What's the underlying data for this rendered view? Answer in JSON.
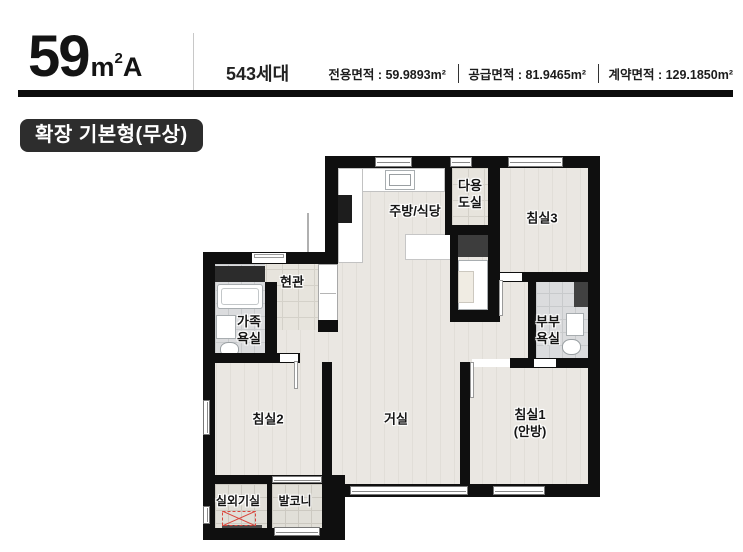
{
  "header": {
    "size_number": "59",
    "size_unit_letter": "m",
    "size_unit_exp": "2",
    "size_variant": "A",
    "households": "543세대",
    "area_specs": [
      "전용면적 : 59.9893m²",
      "공급면적 : 81.9465m²",
      "계약면적 : 129.1850m²"
    ]
  },
  "badge": {
    "label": "확장 기본형(무상)"
  },
  "plan": {
    "rooms": {
      "kitchen": "주방/식당",
      "utility_1": "다용",
      "utility_2": "도실",
      "bedroom3": "침실3",
      "entrance": "현관",
      "family_bath_1": "가족",
      "family_bath_2": "욕실",
      "master_bath_1": "부부",
      "master_bath_2": "욕실",
      "bedroom2": "침실2",
      "living": "거실",
      "bedroom1_1": "침실1",
      "bedroom1_2": "(안방)",
      "ac_room": "실외기실",
      "balcony": "발코니"
    }
  },
  "colors": {
    "wall": "#0f0f0f",
    "bar_black": "#0c0c0c",
    "badge_bg": "#2d2d2d",
    "floor_wood": "#e8e5e0",
    "tile_bath": "#dbdcde",
    "tile_entry": "#e7e4dd",
    "marker_red": "#d9453c"
  }
}
